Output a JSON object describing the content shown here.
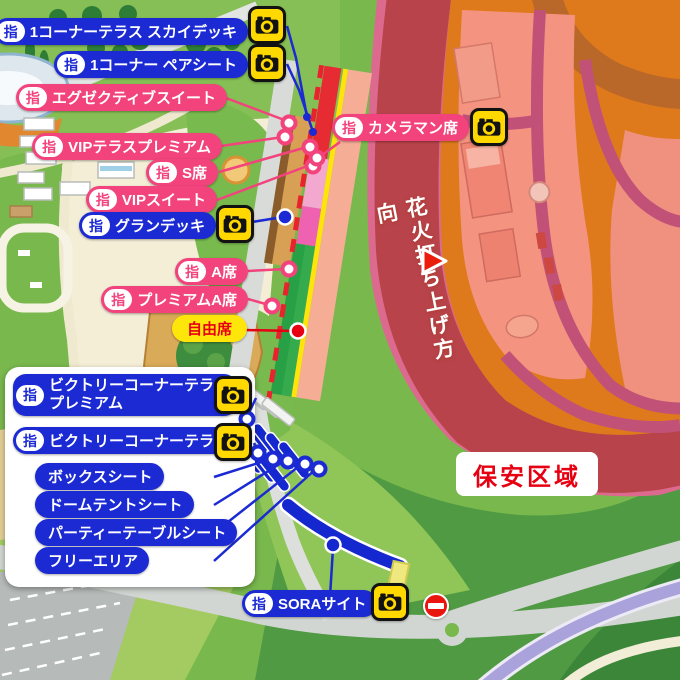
{
  "labels": [
    {
      "badge": "指",
      "text": "1コーナーテラス スカイデッキ"
    },
    {
      "badge": "指",
      "text": "1コーナー ペアシート"
    },
    {
      "badge": "指",
      "text": "エグゼクティブスイート"
    },
    {
      "badge": "指",
      "text": "VIPテラスプレミアム"
    },
    {
      "badge": "指",
      "text": "S席"
    },
    {
      "badge": "指",
      "text": "VIPスイート"
    },
    {
      "badge": "指",
      "text": "グランデッキ"
    },
    {
      "badge": "指",
      "text": "カメラマン席"
    },
    {
      "badge": "指",
      "text": "A席"
    },
    {
      "badge": "指",
      "text": "プレミアムA席"
    },
    {
      "text": "自由席"
    },
    {
      "badge": "指",
      "text": "ビクトリーコーナーテラス",
      "text2": "プレミアム"
    },
    {
      "badge": "指",
      "text": "ビクトリーコーナーテラス"
    },
    {
      "text": "ボックスシート"
    },
    {
      "text": "ドームテントシート"
    },
    {
      "text": "パーティーテーブルシート"
    },
    {
      "text": "フリーエリア"
    },
    {
      "badge": "指",
      "text": "SORAサイト"
    }
  ],
  "annotations": {
    "security_zone": "保安区域",
    "fireworks_direction": "花火打ち上げ方向"
  },
  "icons": {
    "camera": "camera-icon",
    "no_entry": "no-entry-icon",
    "fireworks_arrow": "triangle-right-icon"
  },
  "colors": {
    "reserved_blue": "#1b2ad3",
    "reserved_pink": "#f2437d",
    "free_seat_yellow": "#ffe60a",
    "alert_red": "#e60012",
    "camera_yellow": "#ffd800",
    "security_zone_tint": "#dc6a8e",
    "track_red": "#b8434a",
    "infield_orange": "#de7a1c"
  }
}
